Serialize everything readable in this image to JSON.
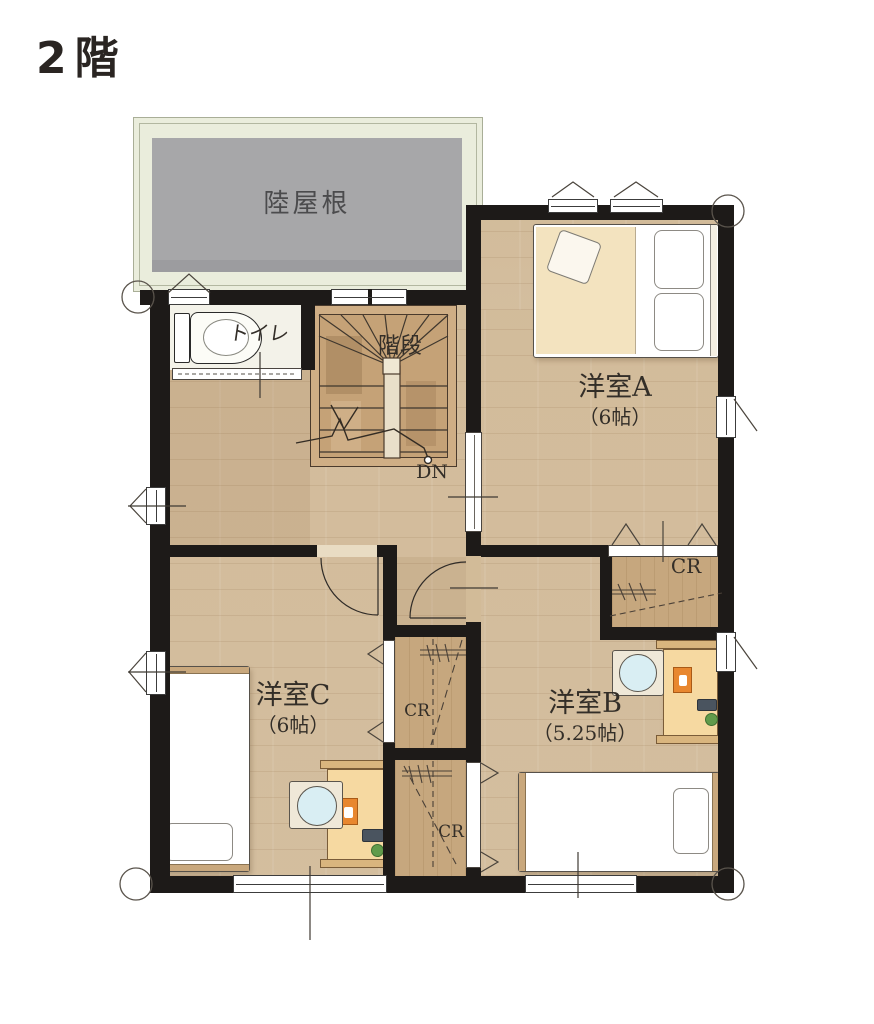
{
  "title": "2階",
  "plan": {
    "roof": {
      "label": "陸屋根"
    },
    "toilet": {
      "label": "トイレ"
    },
    "stairs": {
      "label": "階段",
      "down_label": "DN"
    },
    "rooms": [
      {
        "name": "洋室A",
        "size": "（6帖）"
      },
      {
        "name": "洋室B",
        "size": "（5.25帖）"
      },
      {
        "name": "洋室C",
        "size": "（6帖）"
      }
    ],
    "closets": [
      {
        "id": "cr-north",
        "label": "CR"
      },
      {
        "id": "cr-center-upper",
        "label": "CR"
      },
      {
        "id": "cr-center-lower",
        "label": "CR"
      }
    ],
    "colors": {
      "wall": "#1d1a18",
      "floor_wood": "#d7c2a3",
      "roof_gray": "#a7a7a9",
      "roof_band": "#eaeddc",
      "stair_wood": "#c9a87f",
      "closet_wood": "#c6a77e",
      "desk_wood": "#f6d9a1",
      "picture_orange": "#e8872f",
      "chair_seat_blue": "#d9eef3",
      "plant_green": "#619b4b",
      "label_text": "#332e28"
    }
  }
}
